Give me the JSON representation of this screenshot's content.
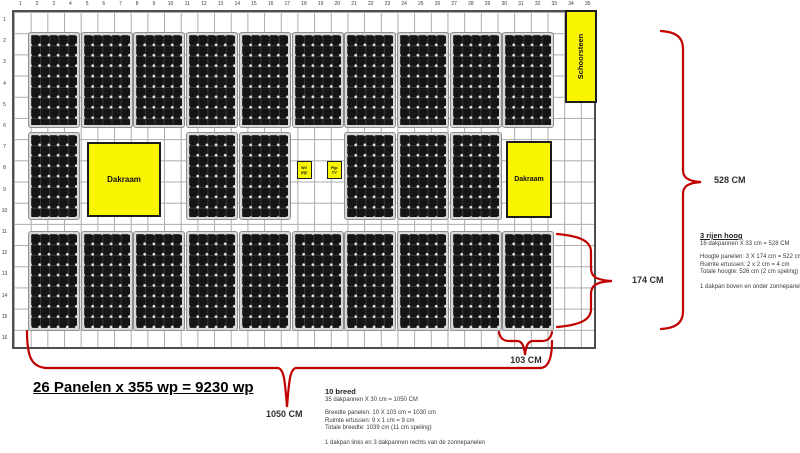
{
  "title": "26 Panelen x 355 wp = 9230 wp",
  "colors": {
    "annotation_red": "#c00000",
    "obstacle_yellow": "#f9f400",
    "panel_black": "#151515",
    "grid_line_gray": "#ababab"
  },
  "grid": {
    "columns": 35,
    "rows": 16
  },
  "obstacles": {
    "dakraam_left": "Dakraam",
    "dakraam_right": "Dakraam",
    "chimney": "Schoorsteen",
    "pipe_left": "WV\npijp",
    "pipe_right": "Pijp\nCV"
  },
  "dimensions": {
    "total_height": "528 CM",
    "panel_height": "174 CM",
    "panel_width": "103 CM",
    "total_width": "1050 CM"
  },
  "notes_right": {
    "heading": "3 rijen hoog",
    "subheading": "16 dakpannen X 33 cm = 528 CM",
    "lines": [
      "Hoogte panelen: 3 X 174 cm = 522 cm",
      "Ruimte ertussen: 2 x 2 cm = 4 cm",
      "Totale hoogte: 526 cm (2 cm speling)"
    ],
    "footer": "1 dakpan boven en onder zonnepanelen"
  },
  "notes_bottom": {
    "heading": "10 breed",
    "subheading": "35 dakpannen X 30 cm = 1050 CM",
    "lines": [
      "Breedte panelen: 10 X 103 cm = 1030 cm",
      "Ruimte ertussen: 9 x 1 cm = 9 cm",
      "Totale breedte: 1039 cm (11 cm speling)"
    ],
    "footer": "1 dakpan links en 3 dakpannen rechts van de zonnepanelen"
  },
  "panel_layout": {
    "panel_count": 26,
    "slot_x": [
      29,
      81.7,
      134.4,
      187.1,
      239.8,
      292.5,
      345.2,
      397.9,
      450.6,
      503.3
    ],
    "panel_w": 50,
    "bands": [
      {
        "y": 33,
        "h": 94,
        "slots": [
          0,
          1,
          2,
          3,
          4,
          5,
          6,
          7,
          8,
          9
        ]
      },
      {
        "y": 133,
        "h": 86,
        "slots": [
          0,
          3,
          4,
          6,
          7,
          8
        ]
      },
      {
        "y": 232,
        "h": 98,
        "slots": [
          0,
          1,
          2,
          3,
          4,
          5,
          6,
          7,
          8,
          9
        ]
      }
    ]
  },
  "grid_geometry": {
    "left": 12,
    "top": 10,
    "cell_w": 16.6857,
    "cell_h": 21.1875
  }
}
